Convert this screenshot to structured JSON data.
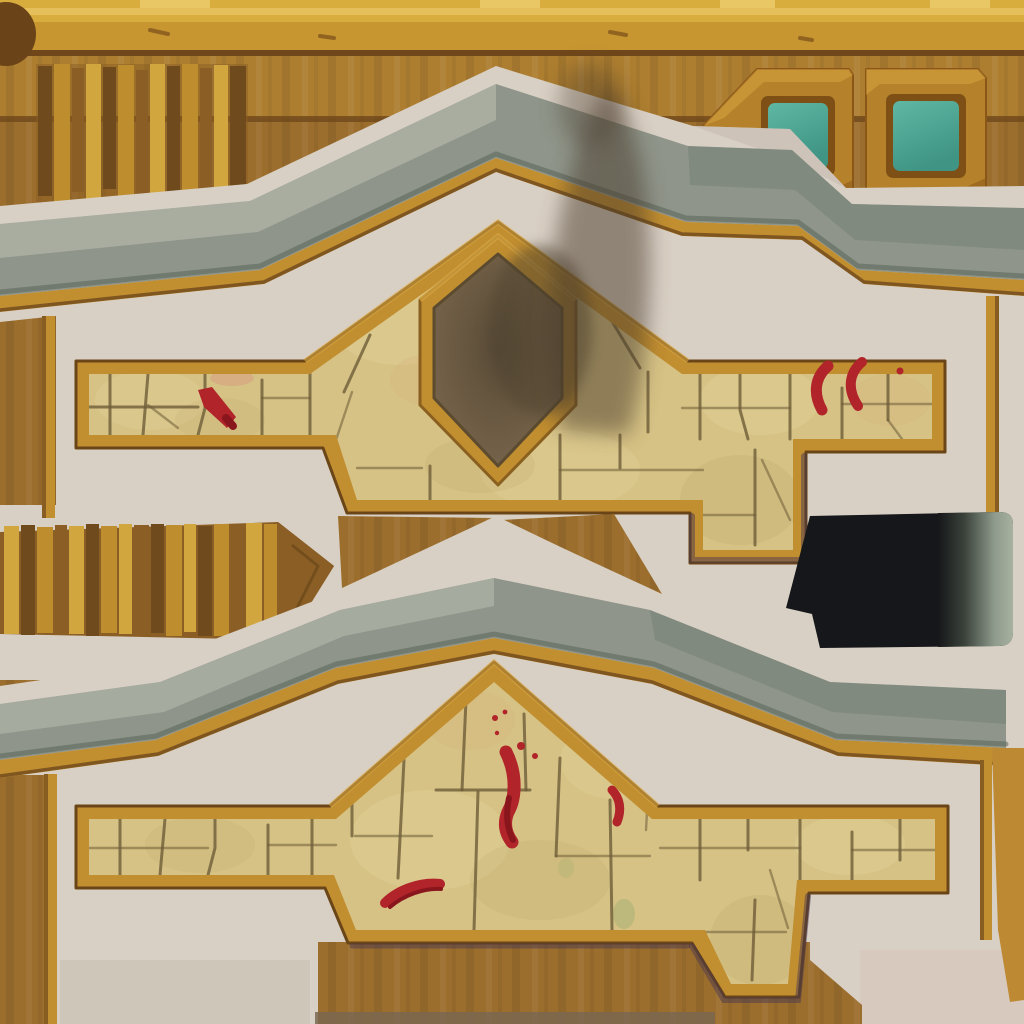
{
  "asset": {
    "kind": "hand-painted building texture atlas",
    "style": "stylized game texture, no text"
  },
  "palette": {
    "bg": "#9c6e2d",
    "bgDark": "#8a5d22",
    "bgLight": "#aa7c36",
    "beam": "#c79631",
    "beamLight": "#d9ac3e",
    "beamHi": "#e9c765",
    "beamSub": "#ad7e30",
    "beamSeam": "#6f471a",
    "knob": "#6b4318",
    "plankDark": "#6f4a1d",
    "plankBrown": "#8a5e24",
    "plankGold": "#bd8d2e",
    "plankGoldLight": "#d2a63e",
    "plankSeam": "#5c3d14",
    "winFrame": "#b5812a",
    "winFrameDark": "#8a5718",
    "winBevel": "#7e5016",
    "pane": "#4aa592",
    "paneLight": "#5fb8a3",
    "plaster": "#d9d0c5",
    "plasterShade": "#c6bbb0",
    "plasterPink": "#d5c6ba",
    "grey": "#8f958a",
    "greyLight": "#bdc1b3",
    "greyDark": "#747f74",
    "greyEdge": "#59645a",
    "gold": "#c18e30",
    "goldHi": "#ddab45",
    "goldDark": "#6e481b",
    "goldSide": "#bd8a33",
    "stone": "#d6c285",
    "stoneLight": "#e6d89e",
    "stoneDark": "#c2ac70",
    "stoneOrange": "#d8b47e",
    "crack": "#6e5c38",
    "moss": "#9fae6e",
    "shield": "#6f5d45",
    "shieldDark": "#4e422f",
    "smoke": "#4a3b2c",
    "black": "#16171a",
    "bandGrey": "#a8b1a0",
    "bandGreyDark": "#3a423a",
    "blood": "#b0242a",
    "bloodDark": "#8a161d",
    "purple": "#433354",
    "bottomDark": "#7a6750",
    "artifactBlue": "#3a3aaa"
  },
  "regions": {
    "top_beam": {
      "name": "wooden-beam-strip",
      "tab_count": 4
    },
    "plank_panel_top": {
      "name": "vertical-plank-panel",
      "plank_count": 13
    },
    "windows": {
      "name": "window-blocks",
      "count": 2,
      "pane_color": "#4aa592"
    },
    "upper_facade": {
      "name": "gabled-wall-upper",
      "features": [
        "stone-masonry",
        "shield-emblem",
        "soot-smudge",
        "blood-marks"
      ]
    },
    "middle_plank_strip": {
      "name": "pointed-plank-strip",
      "plank_count": 17
    },
    "void_panel": {
      "name": "dark-void-panel",
      "gradient_band": true
    },
    "lower_facade": {
      "name": "gabled-wall-lower",
      "features": [
        "stone-masonry",
        "blood-drip",
        "blood-splatter",
        "moss-patches"
      ]
    }
  }
}
